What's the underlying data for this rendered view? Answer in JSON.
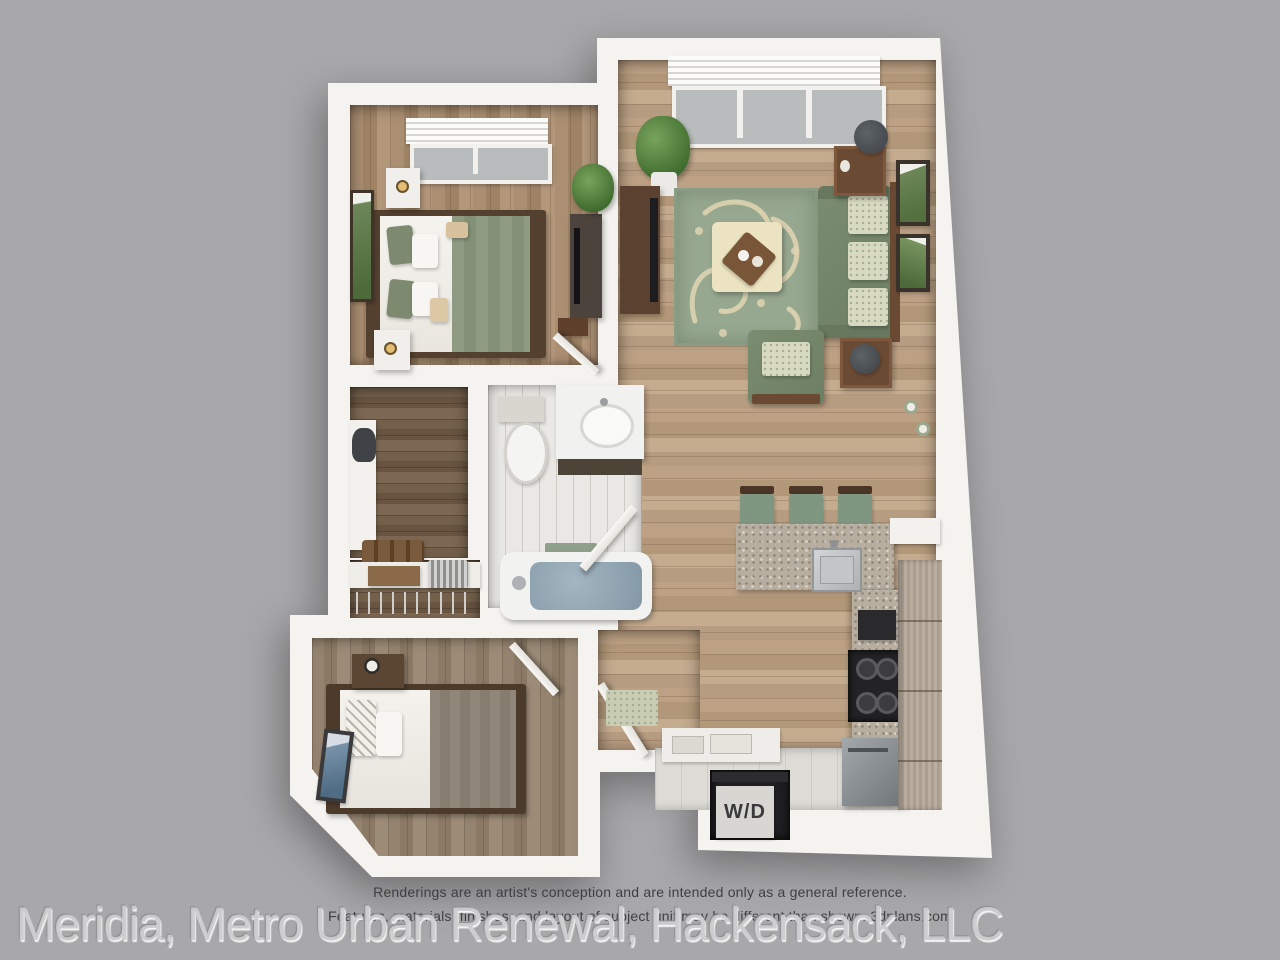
{
  "image_type": "3d-floor-plan-rendering",
  "disclaimer": {
    "line1": "Renderings are an artist's conception and are intended only as a general reference.",
    "line2": "Features, materials, finishes, and layout of subject unit may be different than shown. 3dplans.com"
  },
  "watermark": {
    "text": "Meridia, Metro Urban Renewal, Hackensack, LLC"
  },
  "laundry": {
    "label": "W/D"
  },
  "palette": {
    "background": "#a8a8aa",
    "walls": "#f5f3ef",
    "wood_living": "#b79d81",
    "wood_bedroom1": "#a78b6e",
    "wood_bedroom2": "#8f7e6c",
    "wood_closet": "#6e5947",
    "bath_tile": "#e9e8e4",
    "rug_green": "#97a890",
    "rug_pattern_cream": "#ded4b2",
    "sofa_green": "#75876c",
    "ottoman_cream": "#ebe3c1",
    "dark_wood_furniture": "#5b4130",
    "granite_counter": "#b7aea0",
    "appliance_black": "#232325",
    "appliance_steel": "#8d9296",
    "tub_water": "#8fa4b1",
    "wd_panel": "#d8d6d2"
  }
}
